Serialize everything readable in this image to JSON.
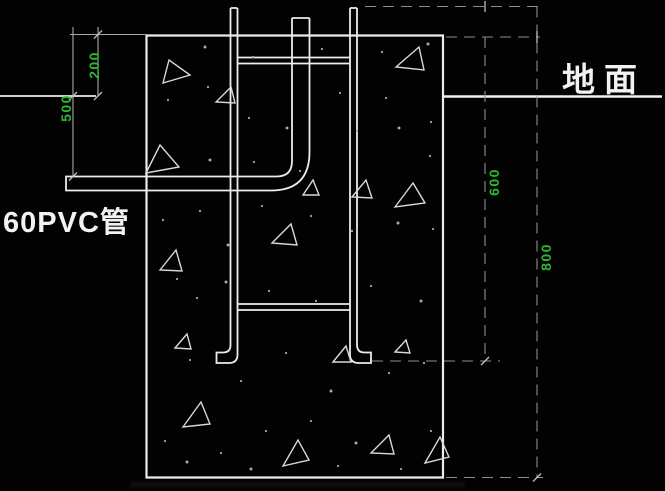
{
  "drawing": {
    "labels": {
      "ground_surface": "地面",
      "pvc_pipe": "60PVC管"
    },
    "dimensions": {
      "block_top_above_ground": "200",
      "pvc_pipe_depth": "500",
      "frame_foot_depth": "600",
      "block_bottom_depth": "800"
    },
    "colors": {
      "background": "#000000",
      "linework": "#ececec",
      "dimension_line": "#a9a9a9",
      "dimension_text": "#2eb82e",
      "label_text": "#f2f2f2"
    },
    "aggregate_triangles": [
      [
        [
          163,
          83
        ],
        [
          169,
          60
        ],
        [
          190,
          75
        ]
      ],
      [
        [
          396,
          67
        ],
        [
          419,
          47
        ],
        [
          424,
          70
        ]
      ],
      [
        [
          216,
          102
        ],
        [
          231,
          87
        ],
        [
          235,
          103
        ]
      ],
      [
        [
          146,
          173
        ],
        [
          160,
          145
        ],
        [
          179,
          167
        ]
      ],
      [
        [
          352,
          197
        ],
        [
          366,
          180
        ],
        [
          372,
          198
        ]
      ],
      [
        [
          395,
          207
        ],
        [
          413,
          183
        ],
        [
          425,
          203
        ]
      ],
      [
        [
          272,
          243
        ],
        [
          291,
          224
        ],
        [
          297,
          245
        ]
      ],
      [
        [
          160,
          270
        ],
        [
          176,
          250
        ],
        [
          182,
          271
        ]
      ],
      [
        [
          175,
          348
        ],
        [
          187,
          334
        ],
        [
          191,
          349
        ]
      ],
      [
        [
          333,
          362
        ],
        [
          346,
          346
        ],
        [
          351,
          362
        ]
      ],
      [
        [
          395,
          352
        ],
        [
          406,
          340
        ],
        [
          410,
          353
        ]
      ],
      [
        [
          183,
          427
        ],
        [
          201,
          402
        ],
        [
          210,
          424
        ]
      ],
      [
        [
          283,
          466
        ],
        [
          298,
          440
        ],
        [
          309,
          460
        ]
      ],
      [
        [
          371,
          453
        ],
        [
          389,
          435
        ],
        [
          394,
          454
        ]
      ],
      [
        [
          425,
          463
        ],
        [
          440,
          437
        ],
        [
          449,
          457
        ]
      ],
      [
        [
          303,
          195
        ],
        [
          313,
          180
        ],
        [
          319,
          195
        ]
      ]
    ],
    "speckles": [
      [
        205,
        47
      ],
      [
        253,
        57
      ],
      [
        322,
        49
      ],
      [
        382,
        52
      ],
      [
        428,
        44
      ],
      [
        168,
        100
      ],
      [
        208,
        87
      ],
      [
        249,
        118
      ],
      [
        287,
        128
      ],
      [
        340,
        93
      ],
      [
        386,
        98
      ],
      [
        431,
        122
      ],
      [
        210,
        160
      ],
      [
        254,
        162
      ],
      [
        300,
        171
      ],
      [
        357,
        131
      ],
      [
        399,
        128
      ],
      [
        430,
        156
      ],
      [
        163,
        220
      ],
      [
        200,
        211
      ],
      [
        228,
        245
      ],
      [
        262,
        206
      ],
      [
        311,
        216
      ],
      [
        352,
        231
      ],
      [
        398,
        223
      ],
      [
        433,
        229
      ],
      [
        177,
        279
      ],
      [
        197,
        298
      ],
      [
        226,
        282
      ],
      [
        269,
        291
      ],
      [
        316,
        301
      ],
      [
        371,
        286
      ],
      [
        421,
        301
      ],
      [
        190,
        360
      ],
      [
        241,
        381
      ],
      [
        286,
        353
      ],
      [
        331,
        391
      ],
      [
        389,
        373
      ],
      [
        424,
        363
      ],
      [
        165,
        441
      ],
      [
        187,
        462
      ],
      [
        221,
        453
      ],
      [
        266,
        431
      ],
      [
        311,
        421
      ],
      [
        356,
        443
      ],
      [
        338,
        466
      ],
      [
        401,
        469
      ],
      [
        431,
        431
      ],
      [
        251,
        469
      ]
    ]
  }
}
